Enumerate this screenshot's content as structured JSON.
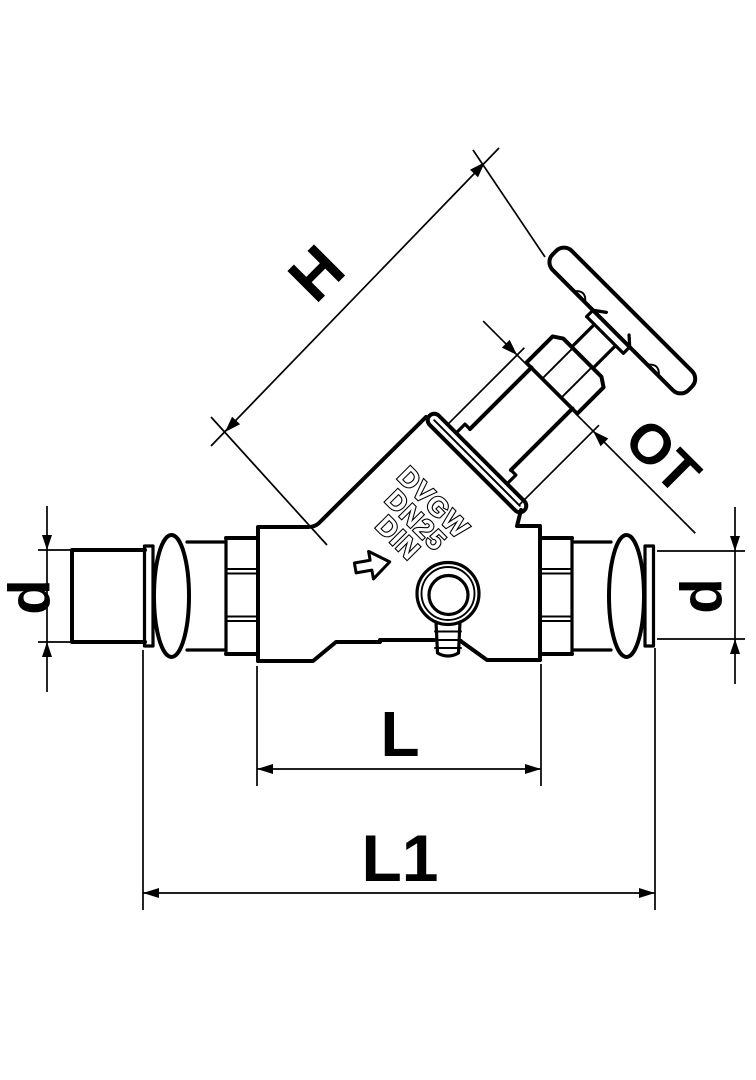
{
  "drawing": {
    "description": "Technical line drawing of a slanted-seat stop valve with press connections, side elevation with dimension callouts",
    "background": "#ffffff",
    "line_color": "#000000"
  },
  "dimensions": {
    "height_label": "H",
    "top_part_label": "OT",
    "diameter_left_label": "d",
    "diameter_right_label": "d",
    "body_length_label": "L",
    "overall_length_label": "L1"
  },
  "cast_markings": {
    "line1": "DVGW",
    "line2": "DN25",
    "line3": "DIN"
  }
}
